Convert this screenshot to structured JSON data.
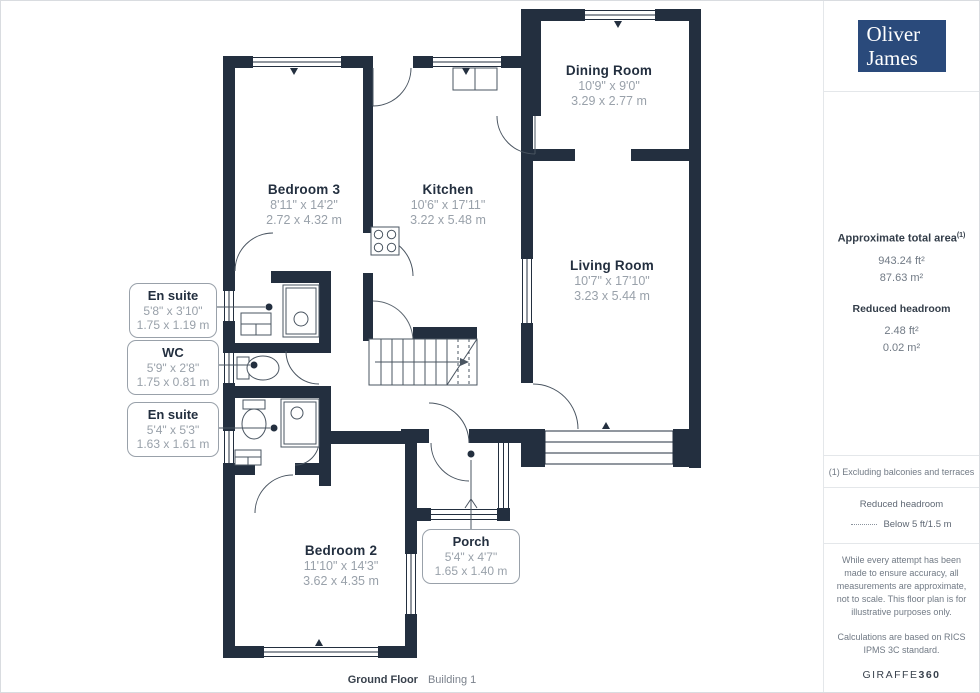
{
  "colors": {
    "wall": "#232f3f",
    "line": "#4a5561",
    "accent": "#2a4a7b",
    "dim_text": "#99a1aa"
  },
  "brand": {
    "line1": "Oliver",
    "line2": "James"
  },
  "sidebar": {
    "area_title": "Approximate total area",
    "area_sup": "(1)",
    "area_ft": "943.24 ft²",
    "area_m": "87.63 m²",
    "headroom_title": "Reduced headroom",
    "headroom_ft": "2.48 ft²",
    "headroom_m": "0.02 m²",
    "footnote": "(1) Excluding balconies and terraces",
    "legend_title": "Reduced headroom",
    "legend_value": "Below 5 ft/1.5 m",
    "disclaimer1": "While every attempt has been made to ensure accuracy, all measurements are approximate, not to scale. This floor plan is for illustrative purposes only.",
    "disclaimer2": "Calculations are based on RICS IPMS 3C standard.",
    "brand_footer_normal": "GIRAFFE",
    "brand_footer_bold": "360"
  },
  "rooms": [
    {
      "name": "Dining Room",
      "imperial": "10'9\" x 9'0\"",
      "metric": "3.29 x 2.77 m"
    },
    {
      "name": "Kitchen",
      "imperial": "10'6\" x 17'11\"",
      "metric": "3.22 x 5.48 m"
    },
    {
      "name": "Bedroom 3",
      "imperial": "8'11\" x 14'2\"",
      "metric": "2.72 x 4.32 m"
    },
    {
      "name": "Living Room",
      "imperial": "10'7\" x 17'10\"",
      "metric": "3.23 x 5.44 m"
    },
    {
      "name": "Bedroom 2",
      "imperial": "11'10\" x 14'3\"",
      "metric": "3.62 x 4.35 m"
    }
  ],
  "callouts": [
    {
      "name": "En suite",
      "imperial": "5'8\" x 3'10\"",
      "metric": "1.75 x 1.19 m"
    },
    {
      "name": "WC",
      "imperial": "5'9\" x 2'8\"",
      "metric": "1.75 x 0.81 m"
    },
    {
      "name": "En suite",
      "imperial": "5'4\" x 5'3\"",
      "metric": "1.63 x 1.61 m"
    },
    {
      "name": "Porch",
      "imperial": "5'4\" x 4'7\"",
      "metric": "1.65 x 1.40 m"
    }
  ],
  "footer": {
    "left": "Ground Floor",
    "right": "Building 1"
  }
}
